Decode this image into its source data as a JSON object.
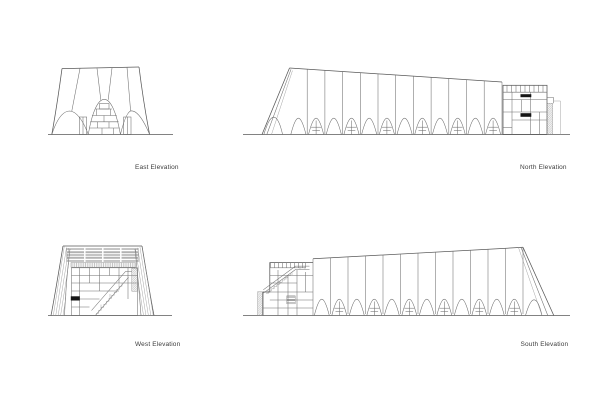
{
  "page": {
    "background": "#ffffff",
    "line_color": "#6e6e6e",
    "outline_color": "#585858",
    "dark_color": "#161616",
    "label_color": "#3d3d3d"
  },
  "elevations": [
    {
      "id": "east",
      "label": "East Elevation"
    },
    {
      "id": "north",
      "label": "North Elevation"
    },
    {
      "id": "west",
      "label": "West Elevation"
    },
    {
      "id": "south",
      "label": "South Elevation"
    }
  ]
}
